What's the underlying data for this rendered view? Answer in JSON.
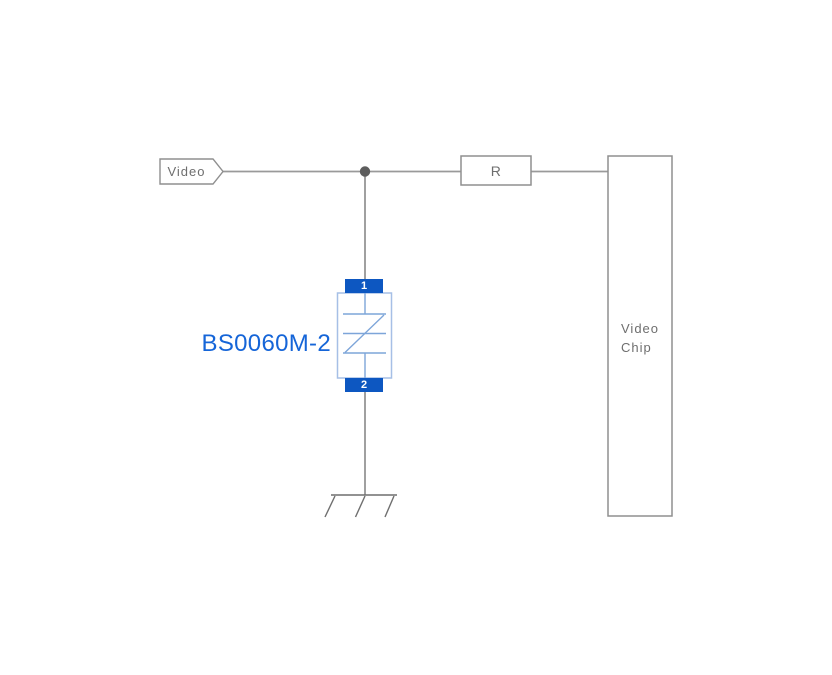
{
  "schematic": {
    "net_tag": {
      "label": "Video"
    },
    "resistor": {
      "label": "R"
    },
    "chip": {
      "label_line1": "Video",
      "label_line2": "Chip"
    },
    "tvs": {
      "label": "BS0060M-2",
      "pin_top": "1",
      "pin_bottom": "2"
    }
  },
  "icons": {
    "ground": "ground-symbol",
    "junction": "junction-dot",
    "net_flag": "net-flag-pentagon",
    "tvs_symbol": "bidirectional-tvs-diode"
  },
  "colors": {
    "pin_blue": "#0d57c1",
    "component_label_blue": "#1565d8",
    "symbol_blue": "#7da5d9",
    "body_outline_blue": "#a6bfe6",
    "wire_gray": "#9a9a9a",
    "outline_gray": "#8f8f8f",
    "text_gray": "#6e6e6e",
    "junction_gray": "#5d5d5d"
  }
}
